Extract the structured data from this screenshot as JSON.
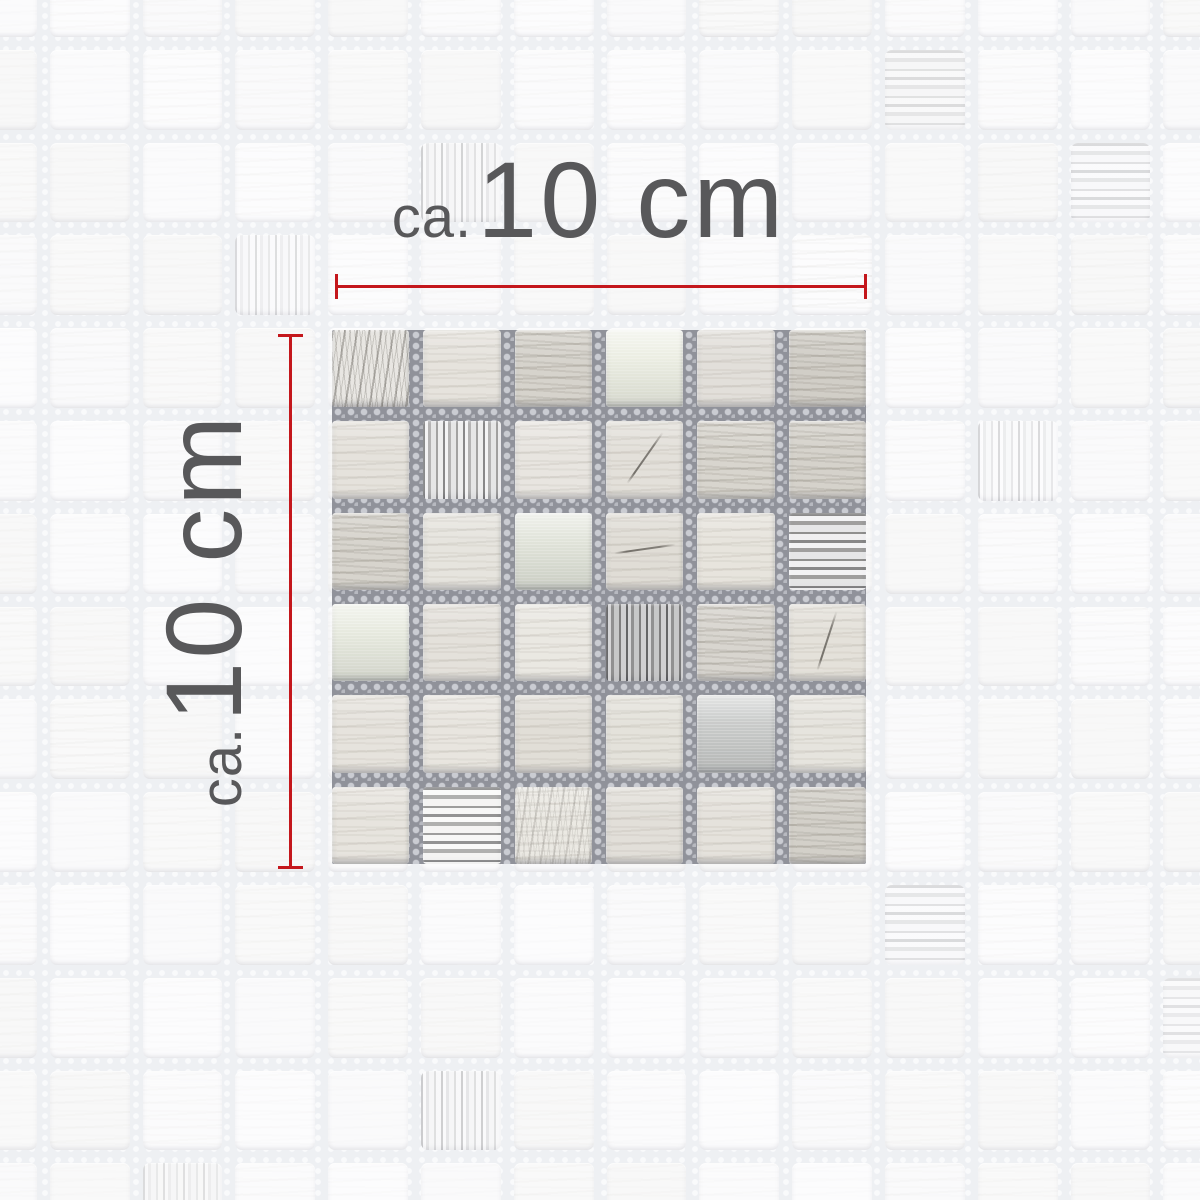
{
  "annotations": {
    "width_label": {
      "prefix": "ca.",
      "value": "10 cm"
    },
    "height_label": {
      "prefix": "ca.",
      "value": "10 cm"
    },
    "text_color": "#58585a",
    "line_color": "#c4171c"
  },
  "sample": {
    "grid": 6,
    "left": 332,
    "top": 330,
    "size": 534,
    "gap": 14,
    "grout_color": "#90929a",
    "tiles": [
      {
        "t": "marble",
        "c": "#e8e6e2"
      },
      {
        "t": "stone",
        "c": "#e6e3dd"
      },
      {
        "t": "stoneg",
        "c": "#d6d3cc"
      },
      {
        "t": "metal",
        "c": "#eaece0"
      },
      {
        "t": "stone",
        "c": "#e2dfda"
      },
      {
        "t": "stoneg",
        "c": "#d1cec7"
      },
      {
        "t": "stone",
        "c": "#e5e2dc"
      },
      {
        "t": "glassv",
        "c": "#c6c4c0"
      },
      {
        "t": "stone",
        "c": "#e8e5e0"
      },
      {
        "t": "stone",
        "c": "#e3e0da",
        "crack": -55
      },
      {
        "t": "stoneg",
        "c": "#d8d5ce"
      },
      {
        "t": "stoneg",
        "c": "#d5d2cb"
      },
      {
        "t": "stoneg",
        "c": "#d7d4cd"
      },
      {
        "t": "stone",
        "c": "#e6e4de"
      },
      {
        "t": "metal",
        "c": "#dee1d6"
      },
      {
        "t": "stone",
        "c": "#e0ddd6",
        "crack": -8
      },
      {
        "t": "stone",
        "c": "#e7e4dd"
      },
      {
        "t": "glassh",
        "c": "#b5b3ae"
      },
      {
        "t": "metal",
        "c": "#e5e8dc"
      },
      {
        "t": "stone",
        "c": "#e4e1db"
      },
      {
        "t": "stone",
        "c": "#eae8e2"
      },
      {
        "t": "glassv",
        "c": "#a2a09c",
        "mod": "dark"
      },
      {
        "t": "stoneg",
        "c": "#d8d5cf"
      },
      {
        "t": "stone",
        "c": "#e4e1da",
        "crack": -72
      },
      {
        "t": "stone",
        "c": "#e6e3dd"
      },
      {
        "t": "stone",
        "c": "#e8e5df"
      },
      {
        "t": "stone",
        "c": "#e1ded7"
      },
      {
        "t": "stone",
        "c": "#e4e2db"
      },
      {
        "t": "metal",
        "c": "#c4c6c5"
      },
      {
        "t": "stone",
        "c": "#e6e4de"
      },
      {
        "t": "stone",
        "c": "#e7e4de"
      },
      {
        "t": "glassh",
        "c": "#cccac5",
        "mod": "bright"
      },
      {
        "t": "stone",
        "c": "#ebe9e3",
        "mod": "fleck"
      },
      {
        "t": "stone",
        "c": "#e2dfd9"
      },
      {
        "t": "stone",
        "c": "#e5e2dc"
      },
      {
        "t": "stoneg",
        "c": "#d3d0c9"
      }
    ]
  },
  "background": {
    "cols": 14,
    "rows": 14,
    "pitch": 92.8,
    "offset": -43,
    "tile_size": 79.8,
    "tile_color": "#fbfbfc",
    "grout_color": "#eef0f3",
    "special_tiles": [
      {
        "col": 8,
        "row": 0,
        "t": "stone",
        "o": 0.35
      },
      {
        "col": 10,
        "row": 1,
        "t": "glassh",
        "o": 0.4
      },
      {
        "col": 5,
        "row": 2,
        "t": "glassv",
        "o": 0.45
      },
      {
        "col": 12,
        "row": 2,
        "t": "glassh",
        "o": 0.45
      },
      {
        "col": 3,
        "row": 3,
        "t": "glassv",
        "o": 0.35
      },
      {
        "col": 9,
        "row": 3,
        "t": "stone",
        "o": 0.45
      },
      {
        "col": 11,
        "row": 5,
        "t": "glassv",
        "o": 0.4
      },
      {
        "col": 1,
        "row": 8,
        "t": "stone",
        "o": 0.3
      },
      {
        "col": 10,
        "row": 10,
        "t": "glassh",
        "o": 0.45
      },
      {
        "col": 13,
        "row": 11,
        "t": "glassh",
        "o": 0.35
      },
      {
        "col": 5,
        "row": 12,
        "t": "glassv",
        "o": 0.5
      },
      {
        "col": 2,
        "row": 13,
        "t": "glassv",
        "o": 0.3
      }
    ]
  }
}
